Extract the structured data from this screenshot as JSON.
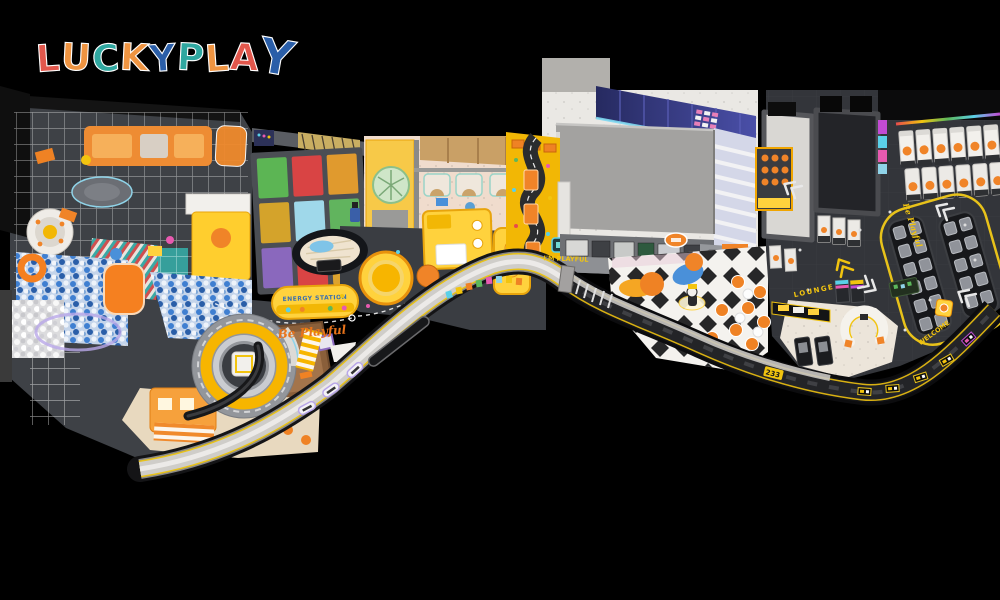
{
  "image": {
    "description": "3D isometric floor-plan render of a LUCKY PLAY indoor playground park on a black background",
    "background": "#000000"
  },
  "logo": {
    "brand": "LUCKYPLAY",
    "letters": [
      {
        "ch": "L",
        "color": "#e2574c"
      },
      {
        "ch": "U",
        "color": "#ef9441"
      },
      {
        "ch": "C",
        "color": "#2fa7a0"
      },
      {
        "ch": "K",
        "color": "#ef9441"
      },
      {
        "ch": "Y",
        "color": "#2a5ea8"
      },
      {
        "ch": "P",
        "color": "#2fa7a0"
      },
      {
        "ch": "L",
        "color": "#ef9441"
      },
      {
        "ch": "A",
        "color": "#e2574c"
      },
      {
        "ch": "Y",
        "color": "#2a5ea8"
      }
    ]
  },
  "floor_texts": {
    "be_playful_left": "Be Playful",
    "energy_station": "ENERGY STATION",
    "im_playful": "I'M PLAYFUL",
    "be_playful_right": "Be Playful",
    "lounge": "LOUNGE",
    "welcome": "WELCOME",
    "gate_number": "233"
  },
  "zones": {
    "trampoline": {
      "tiles": [
        "#5cb554",
        "#d94444",
        "#e09a2e",
        "#d4a32b",
        "#9fd8ea",
        "#61b45e",
        "#8a68bd",
        "#d94444",
        "#dca32e"
      ]
    }
  },
  "palette": {
    "accent_yellow": "#f2c40f",
    "orange": "#ef8224",
    "dark_floor": "#33353a",
    "band_gray": "#cfcdc9",
    "navy_wall": "#2c2f6e",
    "cream_room": "#f0dccd",
    "sand": "#9a6a40",
    "ballpit_blue": "#3f7fd1",
    "mint": "#cfe6c8",
    "neon_pink": "#ff5ad0",
    "neon_cyan": "#5ad0e8"
  }
}
